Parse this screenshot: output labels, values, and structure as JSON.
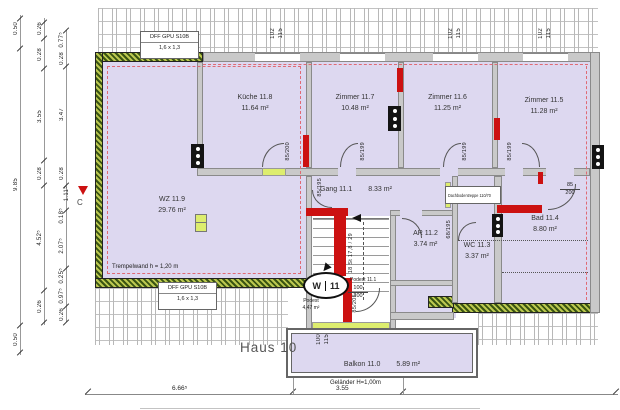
{
  "house_label": "Haus 10",
  "marker": {
    "left": "W",
    "right": "11"
  },
  "rooms": {
    "kueche": {
      "name": "Küche 11.8",
      "area": "11.64 m²"
    },
    "z117": {
      "name": "Zimmer 11.7",
      "area": "10.48 m²"
    },
    "z116": {
      "name": "Zimmer 11.6",
      "area": "11.25 m²"
    },
    "z115": {
      "name": "Zimmer 11.5",
      "area": "11.28 m²"
    },
    "wz": {
      "name": "WZ 11.9",
      "area": "29.76 m²"
    },
    "gang": {
      "name": "Gang 11.1",
      "area": "8.33 m²"
    },
    "ar": {
      "name": "AR 11.2",
      "area": "3.74 m²"
    },
    "wc": {
      "name": "WC 11.3",
      "area": "3.37 m²"
    },
    "bad": {
      "name": "Bad 11.4",
      "area": "8.80 m²"
    },
    "balkon": {
      "name": "Balkon 11.0",
      "area": "5.89 m²"
    },
    "podest": {
      "name": "Podest",
      "area": "4,47 m²"
    },
    "podest_upper": {
      "name": "Podest 11.1"
    }
  },
  "doors": {
    "kueche": "85/200",
    "zimmer117": "85/199",
    "zimmer116": "85/199",
    "zimmer115": "85/199",
    "gang": "85/195",
    "wc": "68/195",
    "stair": "85/205",
    "bad": {
      "w": "85",
      "h": "200"
    },
    "entry": {
      "w": "100",
      "h": "200"
    }
  },
  "windows": {
    "top_sill": {
      "a": "102",
      "b": "115"
    },
    "balcony_sill": {
      "a": "100",
      "b": "115"
    }
  },
  "stairs": {
    "label": "18 St 17,8 / 29"
  },
  "annotations": {
    "trempelwand": "Trempelwand h = 1,20 m",
    "gelaender": "Geländer H=1,00m",
    "dachbodentreppe": "Dachbodentreppe 110/70",
    "dff_gaube_top": {
      "line1": "DFF GPU S10B",
      "line2": "1,6 x 1,3"
    },
    "dff_gaube_bottom": {
      "line1": "DFF GPU S10B",
      "line2": "1,6 x 1,3"
    },
    "section_marker": "C"
  },
  "dimensions": {
    "bottom": {
      "d1": "6.66⁵",
      "d2": "3.55"
    },
    "left_outer": {
      "d1": "0.50",
      "d2": "9.85",
      "d3": "0.50"
    },
    "left_mid": {
      "d1": "0.26",
      "d2": "0.28",
      "d3": "3.55",
      "d4": "0.28",
      "d5": "4.52⁵",
      "d6": "0.26"
    },
    "left_inner": {
      "d1": "0.77⁵",
      "d2": "0.28",
      "d3": "3.47",
      "d4": "0.28",
      "d5": "1.11⁵",
      "d6": "0.18⁵",
      "d7": "2.07⁵",
      "d8": "0.25⁵",
      "d9": "0.97⁵",
      "d10": "0.26"
    }
  },
  "colors": {
    "room_fill": "#ddd8f0",
    "wall_red": "#cc1111",
    "exterior_wall_green": "#3a5512",
    "lintel_green": "#dded6e"
  }
}
